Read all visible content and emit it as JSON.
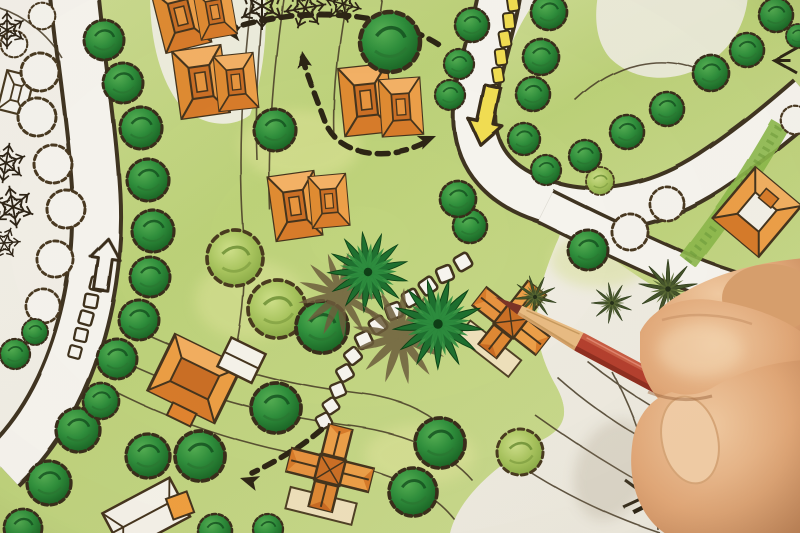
{
  "scene": {
    "description": "Photograph of a hand holding a red colored pencil over a hand-drawn landscape architecture site plan with orange houses, green trees, winding white roads, yellow and white path markers, dashed direction arrows and contour lines.",
    "palette": {
      "paper": "#f2efe7",
      "grass_light": "#cfdd95",
      "grass_mid": "#a8c45e",
      "tree_dark": "#2f8f3c",
      "tree_light": "#a8c45e",
      "house_orange": "#eda049",
      "roof_dark": "#cc7026",
      "ink_outline": "#46351e",
      "road_white": "#f7f5ef",
      "marker_yellow": "#f2de52",
      "pencil_body_red": "#b5402e",
      "pencil_wood": "#e9bc83",
      "pencil_lead": "#7a3427",
      "skin": "#e9b98d"
    },
    "instances": [
      {
        "layer": "markers",
        "symbol": "#stone",
        "name": "stepping-stone",
        "items": [
          [
            463,
            262,
            1,
            -30
          ],
          [
            445,
            274,
            1,
            -22
          ],
          [
            428,
            286,
            1,
            -35
          ],
          [
            411,
            298,
            1,
            -28
          ],
          [
            394,
            311,
            1,
            -20
          ],
          [
            378,
            325,
            1,
            -32
          ],
          [
            364,
            340,
            1,
            -25
          ],
          [
            353,
            356,
            0.95,
            -38
          ],
          [
            345,
            373,
            0.95,
            -30
          ],
          [
            338,
            390,
            0.9,
            -22
          ],
          [
            331,
            406,
            0.9,
            -34
          ],
          [
            324,
            421,
            0.9,
            -28
          ]
        ]
      },
      {
        "layer": "markers",
        "symbol": "#wsq",
        "name": "road-dash-white",
        "items": [
          [
            97,
            284,
            1,
            14
          ],
          [
            91,
            301,
            1,
            10
          ],
          [
            86,
            318,
            1,
            16
          ],
          [
            81,
            335,
            0.95,
            12
          ],
          [
            75,
            352,
            0.9,
            15
          ]
        ]
      },
      {
        "layer": "markers",
        "symbol": "#ydash",
        "name": "road-dash-yellow",
        "items": [
          [
            513,
            3,
            1,
            -8
          ],
          [
            509,
            21,
            1,
            -6
          ],
          [
            505,
            39,
            1,
            -10
          ],
          [
            501,
            57,
            1,
            -7
          ],
          [
            498,
            75,
            0.95,
            -9
          ],
          [
            494,
            92,
            0.9,
            -8
          ]
        ]
      },
      {
        "layer": "vegetation",
        "symbol": "#toutline",
        "name": "tree-outline",
        "items": [
          [
            40,
            72,
            1,
            0
          ],
          [
            37,
            117,
            1,
            0
          ],
          [
            53,
            164,
            1,
            0
          ],
          [
            66,
            209,
            1,
            0
          ],
          [
            55,
            259,
            0.95,
            0
          ],
          [
            43,
            306,
            0.9,
            0
          ],
          [
            14,
            44,
            0.7,
            0
          ],
          [
            42,
            16,
            0.7,
            0
          ],
          [
            630,
            232,
            0.95,
            0
          ],
          [
            667,
            204,
            0.9,
            0
          ],
          [
            795,
            120,
            0.75,
            0
          ]
        ]
      },
      {
        "layer": "vegetation",
        "symbol": "#tlight",
        "name": "canopy-tree",
        "items": [
          [
            235,
            258,
            1.4,
            0
          ],
          [
            277,
            309,
            1.45,
            0
          ],
          [
            520,
            452,
            1.15,
            0
          ],
          [
            600,
            181,
            0.7,
            0
          ]
        ]
      },
      {
        "layer": "vegetation",
        "symbol": "#tdark",
        "name": "deciduous-tree",
        "items": [
          [
            104,
            40,
            1,
            0
          ],
          [
            123,
            83,
            1,
            0
          ],
          [
            141,
            128,
            1.05,
            0
          ],
          [
            148,
            180,
            1.05,
            0
          ],
          [
            153,
            231,
            1.05,
            0
          ],
          [
            150,
            277,
            1,
            0
          ],
          [
            139,
            320,
            1,
            0
          ],
          [
            117,
            359,
            1,
            0
          ],
          [
            78,
            430,
            1.1,
            0
          ],
          [
            49,
            483,
            1.1,
            0
          ],
          [
            23,
            528,
            0.95,
            0
          ],
          [
            148,
            456,
            1.1,
            0
          ],
          [
            200,
            456,
            1.25,
            0
          ],
          [
            101,
            401,
            0.9,
            0
          ],
          [
            215,
            531,
            0.85,
            0
          ],
          [
            268,
            529,
            0.75,
            0
          ],
          [
            15,
            354,
            0.75,
            0
          ],
          [
            35,
            332,
            0.65,
            0
          ],
          [
            275,
            130,
            1.05,
            0
          ],
          [
            390,
            42,
            1.5,
            0
          ],
          [
            470,
            226,
            0.85,
            0
          ],
          [
            458,
            199,
            0.9,
            0
          ],
          [
            322,
            327,
            1.3,
            0
          ],
          [
            276,
            408,
            1.25,
            0
          ],
          [
            440,
            443,
            1.25,
            0
          ],
          [
            413,
            492,
            1.2,
            0
          ],
          [
            472,
            25,
            0.85,
            0
          ],
          [
            459,
            64,
            0.75,
            0
          ],
          [
            450,
            95,
            0.75,
            0
          ],
          [
            549,
            12,
            0.9,
            0
          ],
          [
            541,
            57,
            0.9,
            0
          ],
          [
            533,
            94,
            0.85,
            0
          ],
          [
            524,
            139,
            0.8,
            0
          ],
          [
            546,
            170,
            0.75,
            0
          ],
          [
            585,
            156,
            0.8,
            0
          ],
          [
            627,
            132,
            0.85,
            0
          ],
          [
            667,
            109,
            0.85,
            0
          ],
          [
            711,
            73,
            0.9,
            0
          ],
          [
            747,
            50,
            0.85,
            0
          ],
          [
            776,
            15,
            0.85,
            0
          ],
          [
            798,
            36,
            0.6,
            0
          ],
          [
            588,
            250,
            1.0,
            0
          ]
        ]
      },
      {
        "layer": "vegetation",
        "symbol": "#palm",
        "name": "palm-tree",
        "items": [
          [
            368,
            272,
            1.25,
            -8
          ],
          [
            438,
            324,
            1.4,
            14
          ]
        ]
      },
      {
        "layer": "vegetation",
        "symbol": "#fern",
        "name": "fern",
        "items": [
          [
            668,
            289,
            1.15,
            0
          ],
          [
            612,
            303,
            0.8,
            30
          ],
          [
            535,
            297,
            0.85,
            -15
          ]
        ]
      },
      {
        "layer": "vegetation",
        "symbol": "#pine",
        "name": "pine-tree",
        "items": [
          [
            262,
            6,
            1.0,
            0
          ],
          [
            305,
            8,
            0.9,
            20
          ],
          [
            343,
            4,
            0.8,
            -15
          ],
          [
            7,
            30,
            0.8,
            0
          ],
          [
            6,
            163,
            0.85,
            10
          ],
          [
            13,
            207,
            0.9,
            -10
          ],
          [
            4,
            243,
            0.7,
            25
          ]
        ]
      }
    ],
    "houses": [
      {
        "t": "A",
        "x": 181,
        "y": 16,
        "r": -14,
        "s": 1
      },
      {
        "t": "A",
        "x": 215,
        "y": 12,
        "r": -10,
        "s": 0.78
      },
      {
        "t": "A",
        "x": 201,
        "y": 82,
        "r": -8,
        "s": 1.05
      },
      {
        "t": "A",
        "x": 236,
        "y": 82,
        "r": -6,
        "s": 0.85
      },
      {
        "t": "A",
        "x": 366,
        "y": 100,
        "r": -6,
        "s": 1.05
      },
      {
        "t": "A",
        "x": 401,
        "y": 107,
        "r": -4,
        "s": 0.88
      },
      {
        "t": "A",
        "x": 295,
        "y": 206,
        "r": -8,
        "s": 1
      },
      {
        "t": "A",
        "x": 329,
        "y": 201,
        "r": -5,
        "s": 0.8
      },
      {
        "t": "L",
        "x": 205,
        "y": 378,
        "r": 26,
        "s": 1
      },
      {
        "t": "C",
        "x": 330,
        "y": 470,
        "r": 14,
        "s": 1
      },
      {
        "t": "C",
        "x": 511,
        "y": 321,
        "r": 38,
        "s": 0.95
      },
      {
        "t": "B",
        "x": 757,
        "y": 212,
        "r": 40,
        "s": 1
      },
      {
        "t": "W",
        "x": 148,
        "y": 514,
        "r": -28,
        "s": 1
      },
      {
        "t": "O",
        "x": 16,
        "y": 93,
        "r": 14,
        "s": 1
      }
    ]
  }
}
